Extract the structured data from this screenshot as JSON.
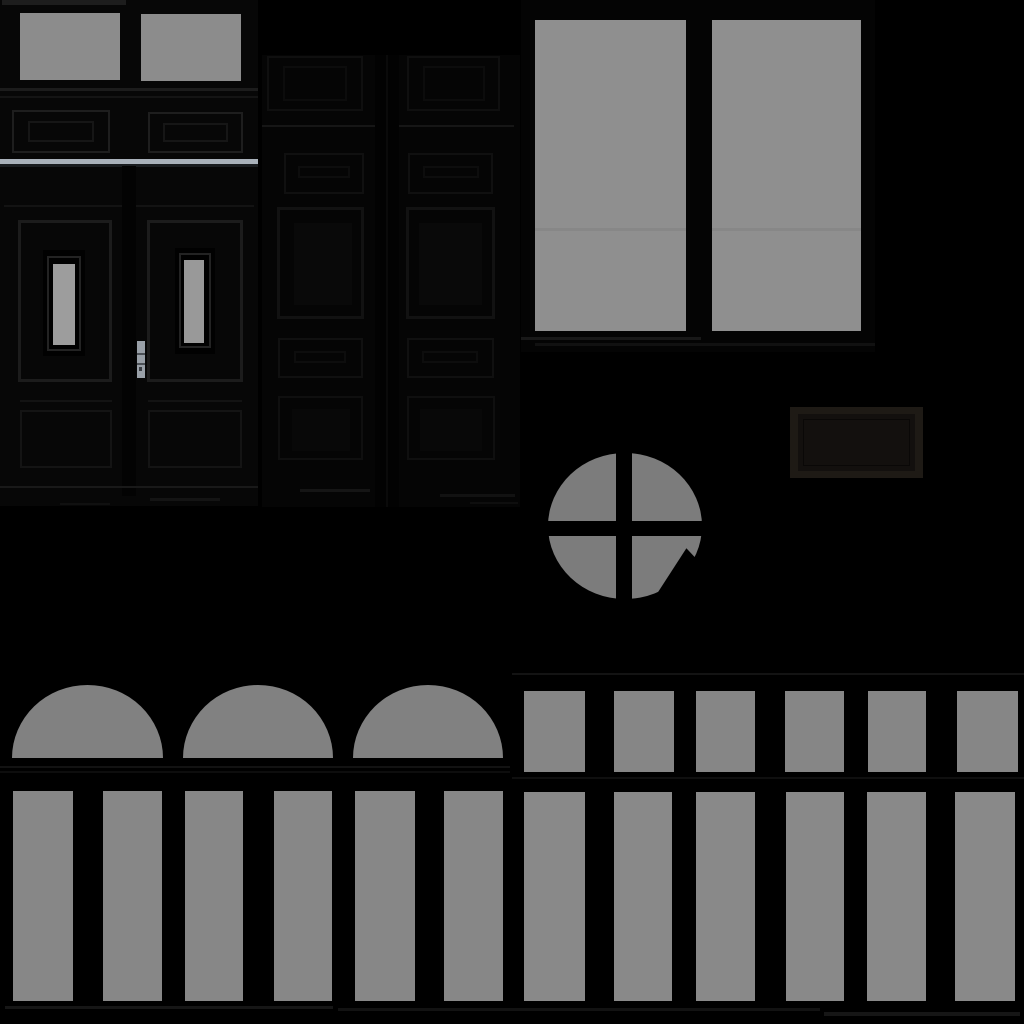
{
  "canvas": {
    "width": 1024,
    "height": 1024,
    "background": "#000000"
  },
  "palette": {
    "background": "#000000",
    "glass_gray": "#8f8f8f",
    "glass_gray_dim": "#818181",
    "glass_gray_round": "#7c7c7c",
    "door_wood_dark": "#070707",
    "panel_line": "#1c1c1c",
    "light_sill": "#a9b1ba",
    "handle_metal": "#99a0a8",
    "plaque_brown": "#1e1a15"
  },
  "sprites": [
    {
      "name": "left-door-base",
      "x": 0,
      "y": 0,
      "w": 258,
      "h": 506,
      "fill": "#070707"
    },
    {
      "name": "left-door-top-rail",
      "x": 2,
      "y": 0,
      "w": 124,
      "h": 5,
      "fill": "#1d1d1d"
    },
    {
      "name": "left-door-transom-left-glass",
      "x": 20,
      "y": 13,
      "w": 100,
      "h": 67,
      "fill": "#8c8c8c"
    },
    {
      "name": "left-door-transom-right-glass",
      "x": 141,
      "y": 14,
      "w": 100,
      "h": 67,
      "fill": "#8c8c8c"
    },
    {
      "name": "left-door-transom-sill-line",
      "x": 0,
      "y": 88,
      "w": 258,
      "h": 3,
      "fill": "#1c1c1c"
    },
    {
      "name": "left-door-rail-line",
      "x": 0,
      "y": 96,
      "w": 258,
      "h": 2,
      "fill": "#141414"
    },
    {
      "name": "left-door-upper-panel-left",
      "x": 12,
      "y": 110,
      "w": 98,
      "h": 43,
      "border": "2px solid #1e1e1e"
    },
    {
      "name": "left-door-upper-panel-left-inner",
      "x": 28,
      "y": 121,
      "w": 66,
      "h": 21,
      "border": "2px solid #161616"
    },
    {
      "name": "left-door-upper-panel-right",
      "x": 148,
      "y": 112,
      "w": 95,
      "h": 41,
      "border": "2px solid #1e1e1e"
    },
    {
      "name": "left-door-upper-panel-right-inner",
      "x": 163,
      "y": 123,
      "w": 65,
      "h": 19,
      "border": "2px solid #161616"
    },
    {
      "name": "left-door-light-sill",
      "x": 0,
      "y": 159,
      "w": 258,
      "h": 5,
      "fill": "#a9b1ba"
    },
    {
      "name": "left-door-sill-shadow",
      "x": 0,
      "y": 164,
      "w": 258,
      "h": 3,
      "fill": "#191c1f"
    },
    {
      "name": "left-door-mid-rail-line",
      "x": 4,
      "y": 205,
      "w": 250,
      "h": 2,
      "fill": "#131313"
    },
    {
      "name": "left-door-center-stile",
      "x": 122,
      "y": 166,
      "w": 14,
      "h": 330,
      "fill": "#030303"
    },
    {
      "name": "left-door-leaf-frame-left",
      "x": 18,
      "y": 220,
      "w": 94,
      "h": 162,
      "border": "3px solid #1c1c1c"
    },
    {
      "name": "left-door-leaf-frame-right",
      "x": 147,
      "y": 220,
      "w": 96,
      "h": 162,
      "border": "3px solid #1c1c1c"
    },
    {
      "name": "left-door-glass-frame-left",
      "x": 43,
      "y": 250,
      "w": 42,
      "h": 106,
      "fill": "#010101"
    },
    {
      "name": "left-door-glass-molding-left",
      "x": 47,
      "y": 256,
      "w": 34,
      "h": 95,
      "border": "2px solid #232323"
    },
    {
      "name": "left-door-glass-left",
      "x": 53,
      "y": 264,
      "w": 22,
      "h": 81,
      "fill": "#9d9d9d"
    },
    {
      "name": "left-door-glass-frame-right",
      "x": 175,
      "y": 248,
      "w": 40,
      "h": 106,
      "fill": "#010101"
    },
    {
      "name": "left-door-glass-molding-right",
      "x": 179,
      "y": 253,
      "w": 32,
      "h": 95,
      "border": "2px solid #232323"
    },
    {
      "name": "left-door-glass-right",
      "x": 184,
      "y": 260,
      "w": 20,
      "h": 83,
      "fill": "#999999"
    },
    {
      "name": "door-handle-plate",
      "x": 137,
      "y": 341,
      "w": 8,
      "h": 37,
      "fill": "#99a0a8"
    },
    {
      "name": "door-handle-notch-upper",
      "x": 137,
      "y": 353,
      "w": 8,
      "h": 2,
      "fill": "#4c5157"
    },
    {
      "name": "door-handle-notch-lower",
      "x": 137,
      "y": 363,
      "w": 8,
      "h": 2,
      "fill": "#4c5157"
    },
    {
      "name": "door-handle-keyhole",
      "x": 139,
      "y": 367,
      "w": 3,
      "h": 4,
      "fill": "#3a3e44"
    },
    {
      "name": "left-door-lower-rail-left",
      "x": 20,
      "y": 400,
      "w": 92,
      "h": 2,
      "fill": "#131313"
    },
    {
      "name": "left-door-lower-rail-right",
      "x": 148,
      "y": 400,
      "w": 94,
      "h": 2,
      "fill": "#131313"
    },
    {
      "name": "left-door-lower-panel-left",
      "x": 20,
      "y": 410,
      "w": 92,
      "h": 58,
      "border": "2px solid #141414"
    },
    {
      "name": "left-door-lower-panel-right",
      "x": 148,
      "y": 410,
      "w": 94,
      "h": 58,
      "border": "2px solid #141414"
    },
    {
      "name": "left-door-bottom-line",
      "x": 0,
      "y": 486,
      "w": 258,
      "h": 2,
      "fill": "#191919"
    },
    {
      "name": "left-door-scuff-1",
      "x": 150,
      "y": 498,
      "w": 70,
      "h": 3,
      "fill": "#141414"
    },
    {
      "name": "left-door-scuff-2",
      "x": 60,
      "y": 503,
      "w": 50,
      "h": 2,
      "fill": "#101010"
    },
    {
      "name": "double-door-base",
      "x": 262,
      "y": 55,
      "w": 258,
      "h": 452,
      "fill": "#050505"
    },
    {
      "name": "double-door-top-panel-left",
      "x": 267,
      "y": 56,
      "w": 96,
      "h": 55,
      "border": "2px solid #0f0f0f"
    },
    {
      "name": "double-door-top-panel-left-inner",
      "x": 283,
      "y": 66,
      "w": 64,
      "h": 35,
      "border": "2px solid #0c0c0c"
    },
    {
      "name": "double-door-top-panel-right",
      "x": 407,
      "y": 56,
      "w": 93,
      "h": 55,
      "border": "2px solid #0f0f0f"
    },
    {
      "name": "double-door-top-panel-right-inner",
      "x": 423,
      "y": 66,
      "w": 62,
      "h": 35,
      "border": "2px solid #0c0c0c"
    },
    {
      "name": "double-door-top-rail-line",
      "x": 262,
      "y": 125,
      "w": 252,
      "h": 2,
      "fill": "#161616"
    },
    {
      "name": "double-door-center-stile",
      "x": 375,
      "y": 55,
      "w": 24,
      "h": 452,
      "fill": "#020202"
    },
    {
      "name": "double-door-stile-line",
      "x": 386,
      "y": 55,
      "w": 2,
      "h": 452,
      "fill": "#0a0a0a"
    },
    {
      "name": "double-door-small-panel-left",
      "x": 284,
      "y": 153,
      "w": 80,
      "h": 41,
      "border": "2px solid #101010"
    },
    {
      "name": "double-door-small-slot-left",
      "x": 298,
      "y": 166,
      "w": 52,
      "h": 12,
      "border": "2px solid #0d0d0d"
    },
    {
      "name": "double-door-small-panel-right",
      "x": 408,
      "y": 153,
      "w": 85,
      "h": 41,
      "border": "2px solid #101010"
    },
    {
      "name": "double-door-small-slot-right",
      "x": 423,
      "y": 166,
      "w": 56,
      "h": 12,
      "border": "2px solid #0d0d0d"
    },
    {
      "name": "double-door-main-panel-left",
      "x": 277,
      "y": 207,
      "w": 87,
      "h": 112,
      "border": "3px solid #121212"
    },
    {
      "name": "double-door-main-panel-left-core",
      "x": 294,
      "y": 223,
      "w": 58,
      "h": 82,
      "fill": "#090909"
    },
    {
      "name": "double-door-main-panel-right",
      "x": 406,
      "y": 207,
      "w": 89,
      "h": 112,
      "border": "3px solid #121212"
    },
    {
      "name": "double-door-main-panel-right-core",
      "x": 419,
      "y": 223,
      "w": 63,
      "h": 82,
      "fill": "#090909"
    },
    {
      "name": "double-door-mid-panel-left",
      "x": 278,
      "y": 338,
      "w": 85,
      "h": 40,
      "border": "2px solid #101010"
    },
    {
      "name": "double-door-mid-slot-left",
      "x": 294,
      "y": 351,
      "w": 52,
      "h": 12,
      "border": "2px solid #0d0d0d"
    },
    {
      "name": "double-door-mid-panel-right",
      "x": 407,
      "y": 338,
      "w": 87,
      "h": 40,
      "border": "2px solid #101010"
    },
    {
      "name": "double-door-mid-slot-right",
      "x": 422,
      "y": 351,
      "w": 56,
      "h": 12,
      "border": "2px solid #0d0d0d"
    },
    {
      "name": "double-door-bottom-panel-left",
      "x": 278,
      "y": 396,
      "w": 85,
      "h": 64,
      "border": "2px solid #0f0f0f"
    },
    {
      "name": "double-door-bottom-panel-left-core",
      "x": 292,
      "y": 409,
      "w": 58,
      "h": 42,
      "fill": "#080808"
    },
    {
      "name": "double-door-bottom-panel-right",
      "x": 407,
      "y": 396,
      "w": 88,
      "h": 64,
      "border": "2px solid #0f0f0f"
    },
    {
      "name": "double-door-bottom-panel-right-core",
      "x": 420,
      "y": 409,
      "w": 62,
      "h": 42,
      "fill": "#080808"
    },
    {
      "name": "double-door-scuff-1",
      "x": 300,
      "y": 489,
      "w": 70,
      "h": 3,
      "fill": "#151515"
    },
    {
      "name": "double-door-scuff-2",
      "x": 440,
      "y": 494,
      "w": 75,
      "h": 3,
      "fill": "#121212"
    },
    {
      "name": "double-door-scuff-3",
      "x": 470,
      "y": 502,
      "w": 48,
      "h": 2,
      "fill": "#0e0e0e"
    },
    {
      "name": "window-pair-frame",
      "x": 521,
      "y": 0,
      "w": 354,
      "h": 352,
      "fill": "#040404"
    },
    {
      "name": "window-left-glass",
      "x": 535,
      "y": 20,
      "w": 151,
      "h": 311,
      "fill": "#8f8f8f"
    },
    {
      "name": "window-right-glass",
      "x": 712,
      "y": 20,
      "w": 149,
      "h": 311,
      "fill": "#8f8f8f"
    },
    {
      "name": "window-left-glass-seam",
      "x": 535,
      "y": 228,
      "w": 151,
      "h": 3,
      "fill": "#878787"
    },
    {
      "name": "window-right-glass-seam",
      "x": 712,
      "y": 228,
      "w": 149,
      "h": 3,
      "fill": "#878787"
    },
    {
      "name": "window-sill-upper",
      "x": 521,
      "y": 337,
      "w": 180,
      "h": 3,
      "fill": "#181818"
    },
    {
      "name": "window-sill-lower",
      "x": 535,
      "y": 343,
      "w": 340,
      "h": 3,
      "fill": "#111111"
    },
    {
      "name": "plaque-frame",
      "x": 790,
      "y": 407,
      "w": 133,
      "h": 71,
      "fill": "#1e1a15"
    },
    {
      "name": "plaque-face",
      "x": 798,
      "y": 414,
      "w": 117,
      "h": 57,
      "fill": "#13100e"
    },
    {
      "name": "plaque-inner-line",
      "x": 803,
      "y": 419,
      "w": 107,
      "h": 47,
      "border": "1px solid #0a0807"
    },
    {
      "name": "round-window-glass",
      "x": 548,
      "y": 453,
      "w": 154,
      "h": 146,
      "fill": "#7c7c7c",
      "radius": "50%"
    },
    {
      "name": "round-window-mullion-vertical",
      "x": 616,
      "y": 445,
      "w": 16,
      "h": 162,
      "fill": "#000000"
    },
    {
      "name": "round-window-mullion-horizontal",
      "x": 533,
      "y": 521,
      "w": 184,
      "h": 15,
      "fill": "#000000"
    },
    {
      "name": "round-window-shadow-cut",
      "x": 645,
      "y": 545,
      "w": 92,
      "h": 65,
      "fill": "#000000",
      "clip": "polygon(45% 5%, 98% 85%, 3% 97%)"
    },
    {
      "name": "upper-row-frame-line",
      "x": 512,
      "y": 673,
      "w": 512,
      "h": 2,
      "fill": "#131313"
    },
    {
      "name": "arched-window-1",
      "x": 12,
      "y": 685,
      "w": 151,
      "h": 73,
      "fill": "#818181",
      "radius": "50% 50% 0 0 / 100% 100% 0 0"
    },
    {
      "name": "arched-window-2",
      "x": 183,
      "y": 685,
      "w": 150,
      "h": 73,
      "fill": "#818181",
      "radius": "50% 50% 0 0 / 100% 100% 0 0"
    },
    {
      "name": "arched-window-3",
      "x": 353,
      "y": 685,
      "w": 150,
      "h": 73,
      "fill": "#818181",
      "radius": "50% 50% 0 0 / 100% 100% 0 0"
    },
    {
      "name": "arch-sill-line",
      "x": 0,
      "y": 766,
      "w": 510,
      "h": 2,
      "fill": "#121212"
    },
    {
      "name": "arch-sill-line-2",
      "x": 0,
      "y": 771,
      "w": 510,
      "h": 2,
      "fill": "#0d0d0d"
    },
    {
      "name": "short-window-1",
      "x": 524,
      "y": 691,
      "w": 61,
      "h": 81,
      "fill": "#868686"
    },
    {
      "name": "short-window-2",
      "x": 614,
      "y": 691,
      "w": 60,
      "h": 81,
      "fill": "#868686"
    },
    {
      "name": "short-window-3",
      "x": 696,
      "y": 691,
      "w": 59,
      "h": 81,
      "fill": "#868686"
    },
    {
      "name": "short-window-4",
      "x": 785,
      "y": 691,
      "w": 59,
      "h": 81,
      "fill": "#868686"
    },
    {
      "name": "short-window-5",
      "x": 868,
      "y": 691,
      "w": 58,
      "h": 81,
      "fill": "#868686"
    },
    {
      "name": "short-window-6",
      "x": 957,
      "y": 691,
      "w": 61,
      "h": 81,
      "fill": "#868686"
    },
    {
      "name": "row-divider-line",
      "x": 512,
      "y": 777,
      "w": 512,
      "h": 2,
      "fill": "#0f0f0f"
    },
    {
      "name": "tall-window-left-1",
      "x": 13,
      "y": 791,
      "w": 60,
      "h": 210,
      "fill": "#878787"
    },
    {
      "name": "tall-window-left-2",
      "x": 103,
      "y": 791,
      "w": 59,
      "h": 210,
      "fill": "#878787"
    },
    {
      "name": "tall-window-left-3",
      "x": 185,
      "y": 791,
      "w": 58,
      "h": 210,
      "fill": "#878787"
    },
    {
      "name": "tall-window-left-4",
      "x": 274,
      "y": 791,
      "w": 58,
      "h": 210,
      "fill": "#878787"
    },
    {
      "name": "tall-window-left-5",
      "x": 355,
      "y": 791,
      "w": 60,
      "h": 210,
      "fill": "#878787"
    },
    {
      "name": "tall-window-left-6",
      "x": 444,
      "y": 791,
      "w": 59,
      "h": 210,
      "fill": "#878787"
    },
    {
      "name": "tall-window-right-1",
      "x": 524,
      "y": 792,
      "w": 61,
      "h": 209,
      "fill": "#898989"
    },
    {
      "name": "tall-window-right-2",
      "x": 614,
      "y": 792,
      "w": 58,
      "h": 209,
      "fill": "#898989"
    },
    {
      "name": "tall-window-right-3",
      "x": 696,
      "y": 792,
      "w": 59,
      "h": 209,
      "fill": "#898989"
    },
    {
      "name": "tall-window-right-4",
      "x": 786,
      "y": 792,
      "w": 58,
      "h": 209,
      "fill": "#898989"
    },
    {
      "name": "tall-window-right-5",
      "x": 867,
      "y": 792,
      "w": 59,
      "h": 209,
      "fill": "#898989"
    },
    {
      "name": "tall-window-right-6",
      "x": 955,
      "y": 792,
      "w": 60,
      "h": 209,
      "fill": "#898989"
    },
    {
      "name": "bottom-sill-line-left",
      "x": 5,
      "y": 1006,
      "w": 328,
      "h": 3,
      "fill": "#161616"
    },
    {
      "name": "bottom-sill-line-mid",
      "x": 338,
      "y": 1008,
      "w": 482,
      "h": 3,
      "fill": "#121212"
    },
    {
      "name": "bottom-sill-line-right",
      "x": 824,
      "y": 1012,
      "w": 196,
      "h": 4,
      "fill": "#161616"
    }
  ]
}
